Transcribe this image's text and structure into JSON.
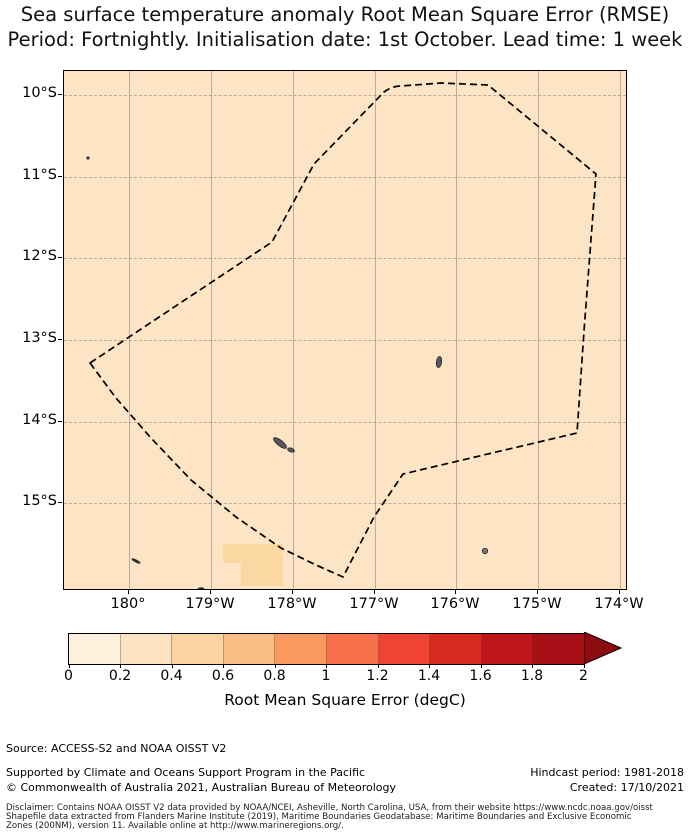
{
  "title": {
    "line1": "Sea surface temperature anomaly Root Mean Square Error (RMSE)",
    "line2": "Period: Fortnightly. Initialisation date: 1st October. Lead time: 1 week"
  },
  "map": {
    "x_ticks": [
      "180°",
      "179°W",
      "178°W",
      "177°W",
      "176°W",
      "175°W",
      "174°W"
    ],
    "y_ticks": [
      "10°S",
      "11°S",
      "12°S",
      "13°S",
      "14°S",
      "15°S"
    ],
    "background_color": "#FCE4C4",
    "patch_color": "#FBD7A1",
    "boundary_style": "black dashed EEZ polygon",
    "island_color": "#56565E"
  },
  "colorbar": {
    "ticks": [
      "0",
      "0.2",
      "0.4",
      "0.6",
      "0.8",
      "1",
      "1.2",
      "1.4",
      "1.6",
      "1.8",
      "2"
    ],
    "label": "Root Mean Square Error (degC)",
    "colors": [
      "#FDF0DC",
      "#FCE3C3",
      "#FBD3A2",
      "#FABD81",
      "#F99960",
      "#F7704C",
      "#EF4433",
      "#D62A1E",
      "#BE161B",
      "#A50F15"
    ],
    "arrow_color": "#8B0B11"
  },
  "footer": {
    "source": "Source: ACCESS-S2 and NOAA OISST V2",
    "supported": "Supported by Climate and Oceans Support Program in the Pacific",
    "copyright": "© Commonwealth of Australia 2021, Australian Bureau of Meteorology",
    "hindcast": "Hindcast period: 1981-2018",
    "created": "Created: 17/10/2021",
    "disclaimer_line1": "Disclaimer: Contains NOAA OISST V2 data provided by NOAA/NCEI, Asheville, North Carolina, USA, from their website https://www.ncdc.noaa.gov/oisst",
    "disclaimer_line2": "Shapefile data extracted from Flanders Marine Institute (2019), Maritime Boundaries Geodatabase: Maritime Boundaries and Exclusive Economic",
    "disclaimer_line3": "Zones (200NM), version 11. Available online at http://www.marineregions.org/."
  },
  "chart_data": {
    "type": "heatmap",
    "title": "Sea surface temperature anomaly Root Mean Square Error (RMSE)",
    "subtitle": "Period: Fortnightly. Initialisation date: 1st October. Lead time: 1 week",
    "x_tick_labels": [
      "180°",
      "179°W",
      "178°W",
      "177°W",
      "176°W",
      "175°W",
      "174°W"
    ],
    "y_tick_labels": [
      "10°S",
      "11°S",
      "12°S",
      "13°S",
      "14°S",
      "15°S"
    ],
    "x_range_deg_west": [
      180.8,
      173.9
    ],
    "y_range_deg_south": [
      9.7,
      16.1
    ],
    "field_summary": "RMSE nearly uniform in the 0.2-0.4 degC bin over the whole domain; one small patch in the 0.4-0.6 degC bin near 178.4W 15.3S",
    "overlay": "dashed EEZ boundary polygon; islands at ~176.2W 13.3S (Wallis), ~178.1W 14.3S (Futuna), plus several islets",
    "grid": true,
    "colorbar": {
      "label": "Root Mean Square Error (degC)",
      "ticks": [
        0,
        0.2,
        0.4,
        0.6,
        0.8,
        1,
        1.2,
        1.4,
        1.6,
        1.8,
        2
      ],
      "extend": "max",
      "bin_colors": [
        "#FDF0DC",
        "#FCE3C3",
        "#FBD3A2",
        "#FABD81",
        "#F99960",
        "#F7704C",
        "#EF4433",
        "#D62A1E",
        "#BE161B",
        "#A50F15"
      ]
    }
  }
}
